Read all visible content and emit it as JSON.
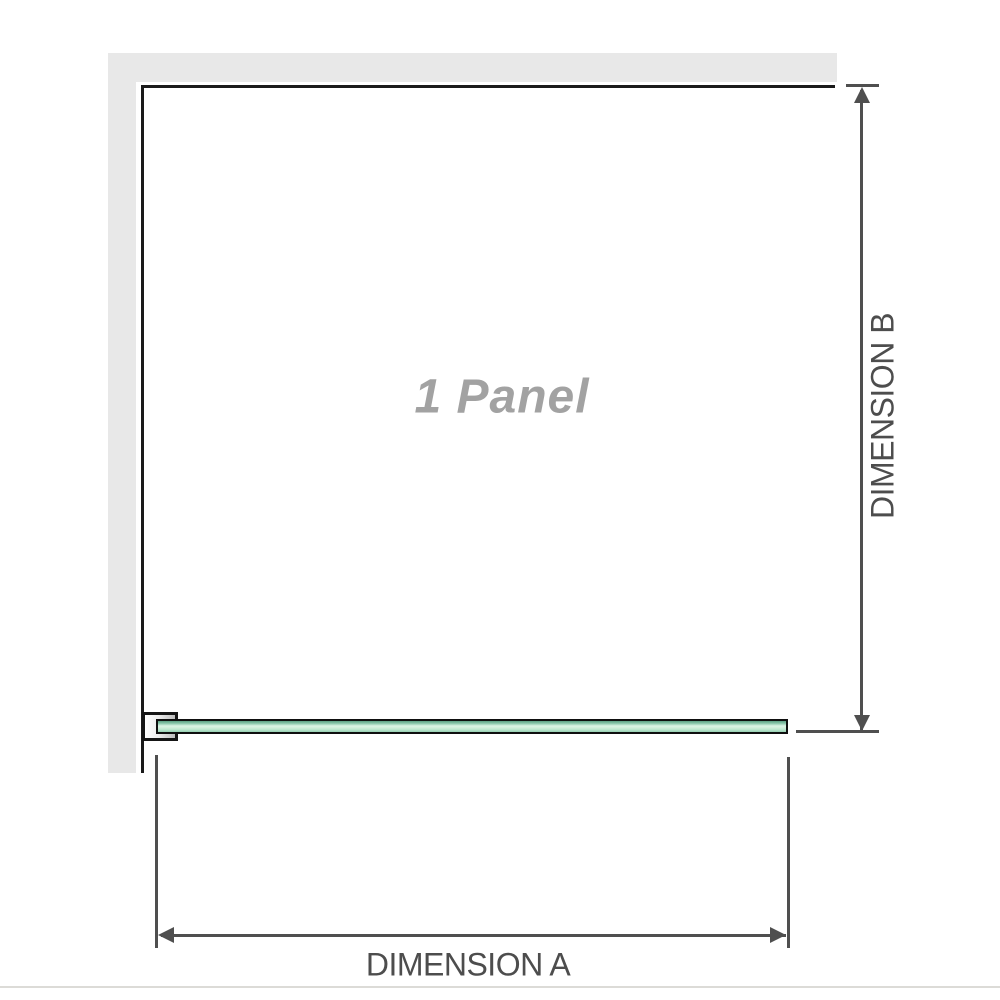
{
  "diagram": {
    "panel_label": "1 Panel",
    "dimension_a": {
      "label": "DIMENSION A"
    },
    "dimension_b": {
      "label": "DIMENSION B"
    },
    "icons": {
      "dimension_a": [
        "arrow-left-icon",
        "arrow-right-icon"
      ],
      "dimension_b": [
        "arrow-up-icon",
        "arrow-down-icon"
      ]
    },
    "colors": {
      "wall": "#e8e8e8",
      "panel_outline": "#1a1a1a",
      "dimension_lines": "#4f4f4f",
      "dimension_text": "#4d4d4d",
      "panel_label_text": "#a2a2a2",
      "glass_green_dark": "#5d9f83",
      "glass_green_light": "#ddf4e6",
      "bracket_fill": "#bdbdbd",
      "baseline_rule": "#dcdbd7"
    }
  }
}
